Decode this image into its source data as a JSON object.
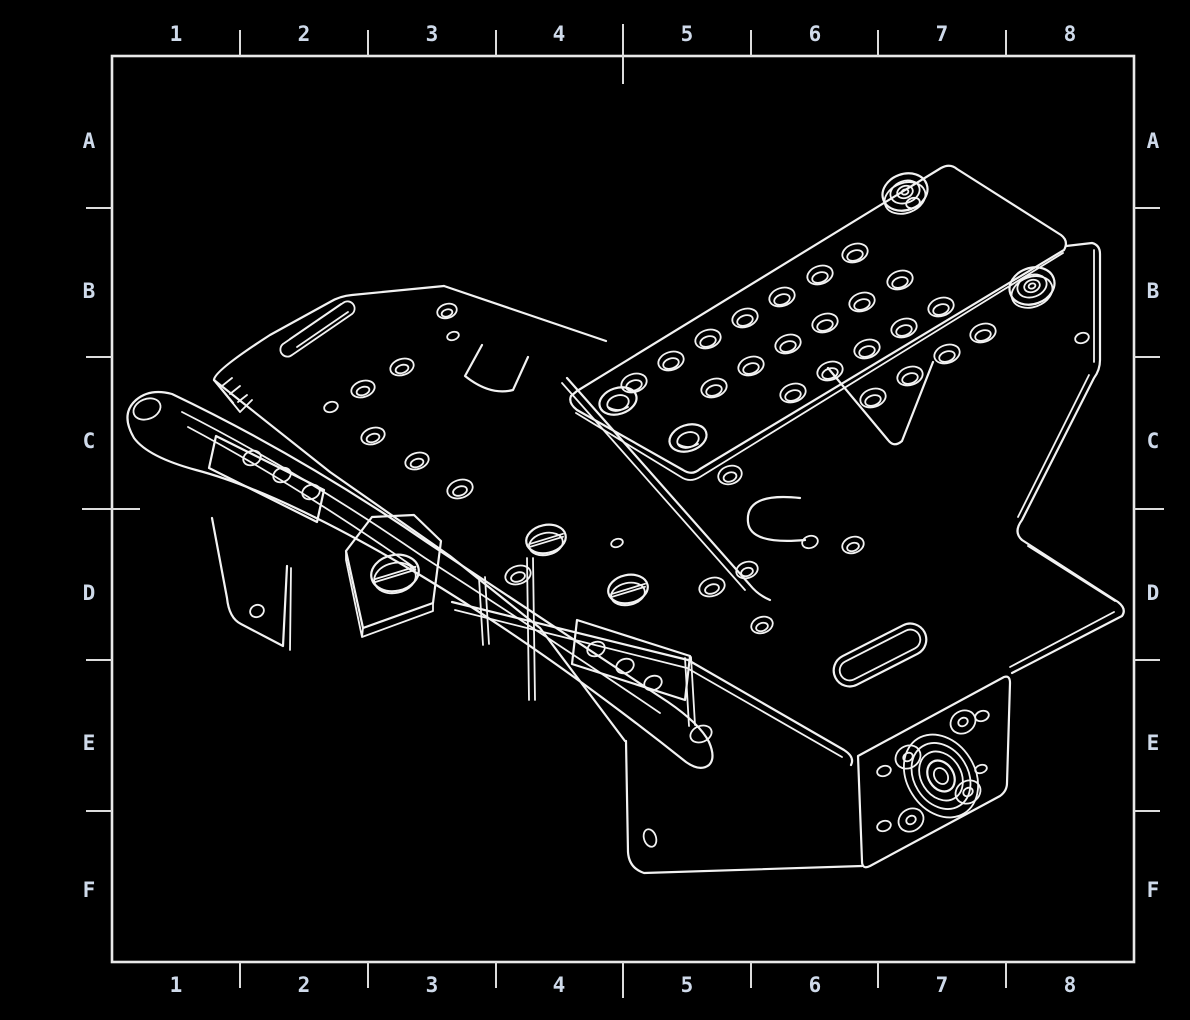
{
  "meta": {
    "description": "Black-background isometric CAD wireframe drawing of a sheet-metal robot chassis assembly inside a bordered drawing sheet with zone grid labels"
  },
  "colors": {
    "background": "#000000",
    "line": "#f2f2f2",
    "label": "#cfdaea"
  },
  "grid": {
    "columns": [
      "1",
      "2",
      "3",
      "4",
      "5",
      "6",
      "7",
      "8"
    ],
    "rows": [
      "A",
      "B",
      "C",
      "D",
      "E",
      "F"
    ],
    "frame": {
      "left": 112,
      "top": 56,
      "right": 1134,
      "bottom": 962
    },
    "col_ticks": [
      240,
      368,
      496,
      623,
      751,
      878,
      1006
    ],
    "row_ticks": [
      208,
      357,
      509,
      660,
      811
    ],
    "center_col_tick": 623,
    "center_row_tick": 509,
    "col_centers": [
      176,
      304,
      432,
      559,
      687,
      815,
      942,
      1070
    ],
    "row_centers": [
      140,
      290,
      440,
      592,
      742,
      889
    ],
    "top_label_y": 33,
    "bottom_label_y": 984,
    "left_label_x": 89,
    "right_label_x": 1153
  },
  "drawing": {
    "plate_holes": [
      [
        855,
        253
      ],
      [
        820,
        275
      ],
      [
        900,
        280
      ],
      [
        782,
        297
      ],
      [
        862,
        302
      ],
      [
        941,
        307
      ],
      [
        745,
        318
      ],
      [
        825,
        323
      ],
      [
        904,
        328
      ],
      [
        983,
        333
      ],
      [
        708,
        339
      ],
      [
        788,
        344
      ],
      [
        867,
        349
      ],
      [
        947,
        354
      ],
      [
        671,
        361
      ],
      [
        751,
        366
      ],
      [
        830,
        371
      ],
      [
        910,
        376
      ],
      [
        634,
        383
      ],
      [
        714,
        388
      ],
      [
        793,
        393
      ],
      [
        873,
        398
      ]
    ],
    "counterbores": [
      [
        618,
        401
      ],
      [
        688,
        438
      ]
    ],
    "ring_holes": [
      [
        447,
        311,
        10,
        7
      ],
      [
        402,
        367,
        12,
        8
      ],
      [
        363,
        389,
        12,
        8
      ],
      [
        373,
        436,
        12,
        8
      ],
      [
        417,
        461,
        12,
        8
      ],
      [
        460,
        489,
        13,
        9
      ],
      [
        730,
        475,
        12,
        9
      ],
      [
        853,
        545,
        11,
        8
      ],
      [
        747,
        570,
        11,
        8
      ],
      [
        712,
        587,
        13,
        9
      ],
      [
        518,
        575,
        13,
        9
      ],
      [
        762,
        625,
        11,
        8
      ]
    ],
    "small_holes": [
      [
        453,
        336,
        6,
        4
      ],
      [
        331,
        407,
        7,
        5
      ],
      [
        810,
        542,
        8,
        6
      ],
      [
        617,
        543,
        6,
        4
      ],
      [
        913,
        203,
        7,
        5
      ],
      [
        1082,
        338,
        7,
        5
      ],
      [
        650,
        838,
        6,
        9
      ],
      [
        884,
        771,
        7,
        5
      ],
      [
        982,
        716,
        7,
        5
      ],
      [
        884,
        826,
        7,
        5
      ],
      [
        981,
        769,
        6,
        4
      ]
    ],
    "arm_holes": [
      [
        147,
        409,
        14,
        10
      ],
      [
        701,
        734,
        11,
        8
      ],
      [
        252,
        458,
        9,
        7
      ],
      [
        282,
        475,
        9,
        7
      ],
      [
        311,
        492,
        9,
        7
      ],
      [
        257,
        611,
        7,
        6
      ],
      [
        596,
        649,
        9,
        7
      ],
      [
        625,
        666,
        9,
        7
      ],
      [
        653,
        683,
        9,
        7
      ]
    ],
    "screws": [
      [
        395,
        573,
        24,
        18
      ],
      [
        546,
        539,
        20,
        14
      ],
      [
        628,
        589,
        20,
        14
      ]
    ],
    "grommets": [
      [
        905,
        192
      ],
      [
        1032,
        286
      ]
    ],
    "bearing": {
      "cx": 941,
      "cy": 776,
      "angle": -32,
      "rings": [
        [
          34,
          44
        ],
        [
          27,
          35
        ],
        [
          20,
          26
        ],
        [
          12.5,
          16.5
        ],
        [
          6.5,
          8.5
        ]
      ],
      "lobes": [
        [
          963,
          722
        ],
        [
          908,
          757
        ],
        [
          911,
          820
        ],
        [
          968,
          792
        ]
      ]
    },
    "slot": {
      "cx": 880,
      "cy": 655,
      "len": 100,
      "h": 32,
      "angle": -27
    }
  }
}
